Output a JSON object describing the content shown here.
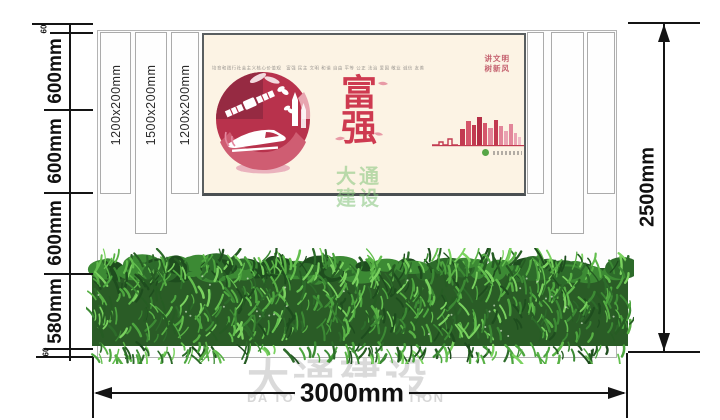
{
  "dims": {
    "left_labels": [
      "60",
      "600mm",
      "600mm",
      "600mm",
      "580mm",
      "60"
    ],
    "right_label": "2500mm",
    "bottom_label": "3000mm"
  },
  "strips": {
    "left": [
      "1200x200mm",
      "1500x200mm",
      "1200x200mm"
    ]
  },
  "poster": {
    "header_line": "培育和践行社会主义核心价值观　富强 民主 文明 和谐 自由 平等 公正 法治 爱国 敬业 诚信 友善",
    "slogan_line1": "讲文明",
    "slogan_line2": "树新风",
    "main_char1": "富",
    "main_char2": "强"
  },
  "watermarks": {
    "center_line1": "大通",
    "center_line2": "建设",
    "bottom_cn": "大通建设",
    "bottom_en": "DA TONG CONSTRUCTION"
  },
  "colors": {
    "dimension_line": "#141414",
    "poster_background": "#fcf3e4",
    "poster_red": "#ce3a50",
    "slogan_red": "#c4606e",
    "artwork_crimson": "#b8324c",
    "watermark_green": "#82c378",
    "watermark_gray": "#dadada",
    "hedge_palette": [
      "#1e4d1e",
      "#2d6b2a",
      "#3c8a34",
      "#4da63f",
      "#63bf4e",
      "#7ad25f",
      "#265c23",
      "#58b145"
    ]
  }
}
